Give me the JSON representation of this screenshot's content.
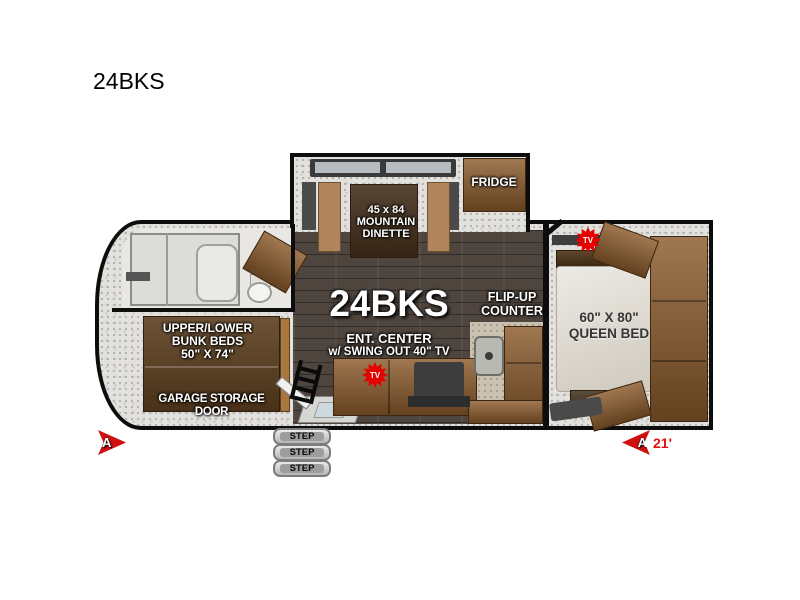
{
  "title": "24BKS",
  "floorplan": {
    "model_label": "24BKS",
    "dinette": {
      "size": "45 x 84",
      "name_line1": "MOUNTAIN",
      "name_line2": "DINETTE"
    },
    "fridge_label": "FRIDGE",
    "flip_up_counter": {
      "line1": "FLIP-UP",
      "line2": "COUNTER"
    },
    "ent_center": {
      "line1": "ENT. CENTER",
      "line2": "w/ SWING OUT 40\" TV"
    },
    "bunk_beds": {
      "line1": "UPPER/LOWER",
      "line2": "BUNK BEDS",
      "line3": "50\" X 74\""
    },
    "garage_label": "GARAGE STORAGE DOOR",
    "queen_bed": {
      "line1": "60\" X 80\"",
      "line2": "QUEEN BED"
    },
    "tv_label": "TV",
    "steps": [
      "STEP",
      "STEP",
      "STEP"
    ],
    "marker_a_left": "A",
    "marker_a_right": "A",
    "length_label": "21'"
  },
  "colors": {
    "wall": "#0d0d0d",
    "wood_cabinet": "#8a5a2b",
    "dark_wood": "#5d3f1f",
    "floor_speckle": "#e2e1dd",
    "wood_floor": "#4e453e",
    "accent_red": "#d01010",
    "bed_linen": "#dbd5c9",
    "appliance_gray": "#3e3e3e"
  }
}
